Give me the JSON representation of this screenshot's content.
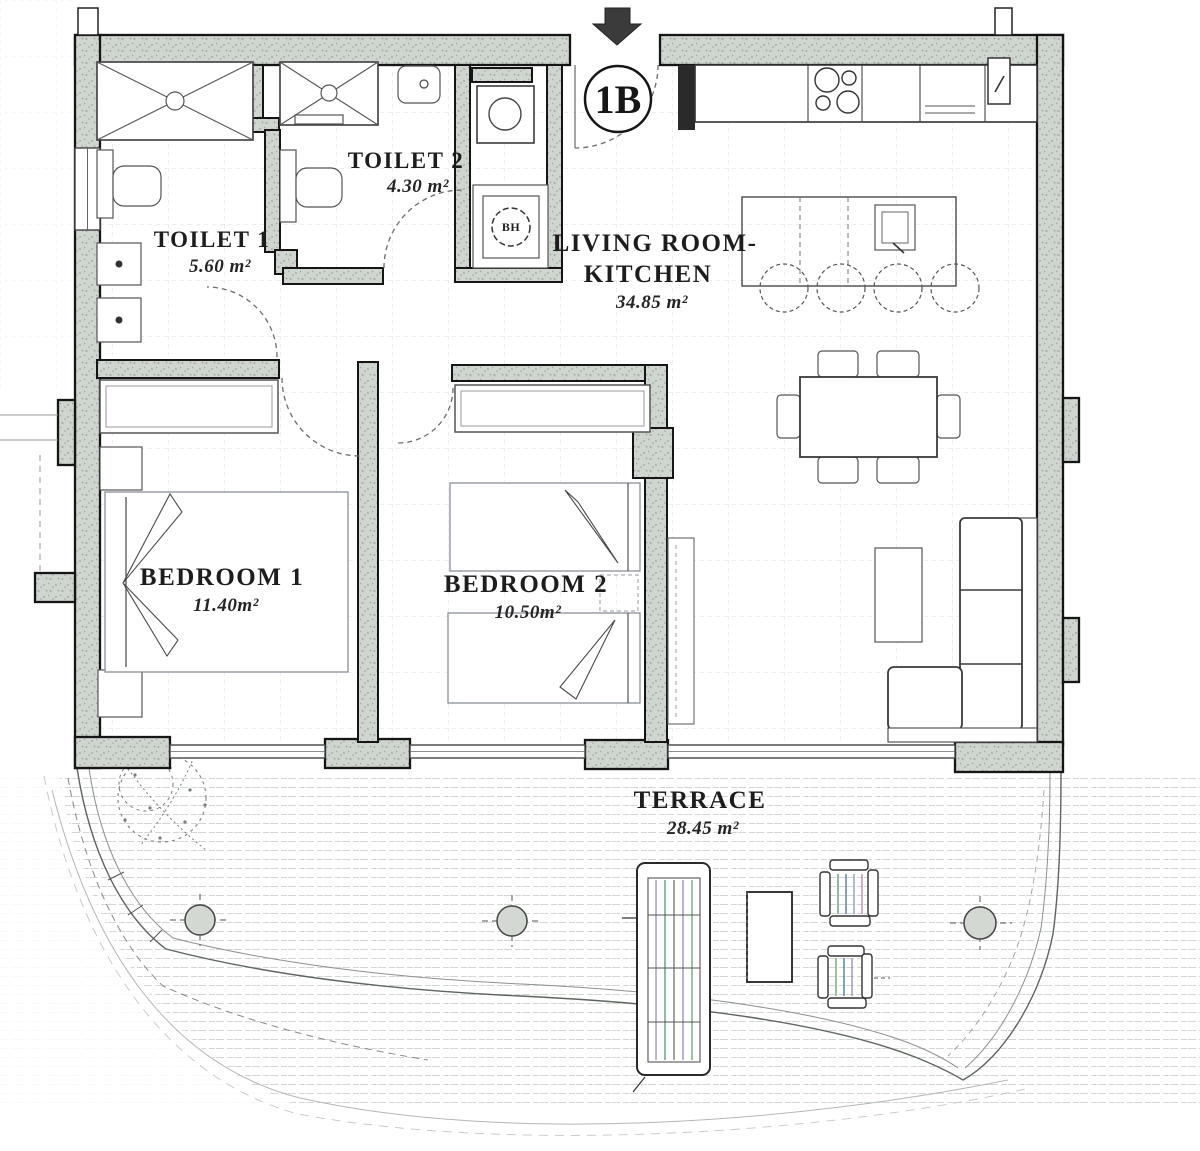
{
  "unit": {
    "label": "1B"
  },
  "rooms": {
    "toilet1": {
      "name": "TOILET 1",
      "area": "5.60 m²"
    },
    "toilet2": {
      "name": "TOILET 2",
      "area": "4.30 m²"
    },
    "living_kitchen": {
      "name_line1": "LIVING ROOM-",
      "name_line2": "KITCHEN",
      "area": "34.85 m²"
    },
    "bedroom1": {
      "name": "BEDROOM 1",
      "area": "11.40m²"
    },
    "bedroom2": {
      "name": "BEDROOM 2",
      "area": "10.50m²"
    },
    "terrace": {
      "name": "TERRACE",
      "area": "28.45 m²"
    }
  },
  "fixtures": {
    "water_heater_label": "BH"
  },
  "colors": {
    "wall_fill": "#cfd5cf",
    "line_dark": "#1a1a1a",
    "tile_line": "#c9d1da",
    "deck_line": "#b4bcb4"
  }
}
